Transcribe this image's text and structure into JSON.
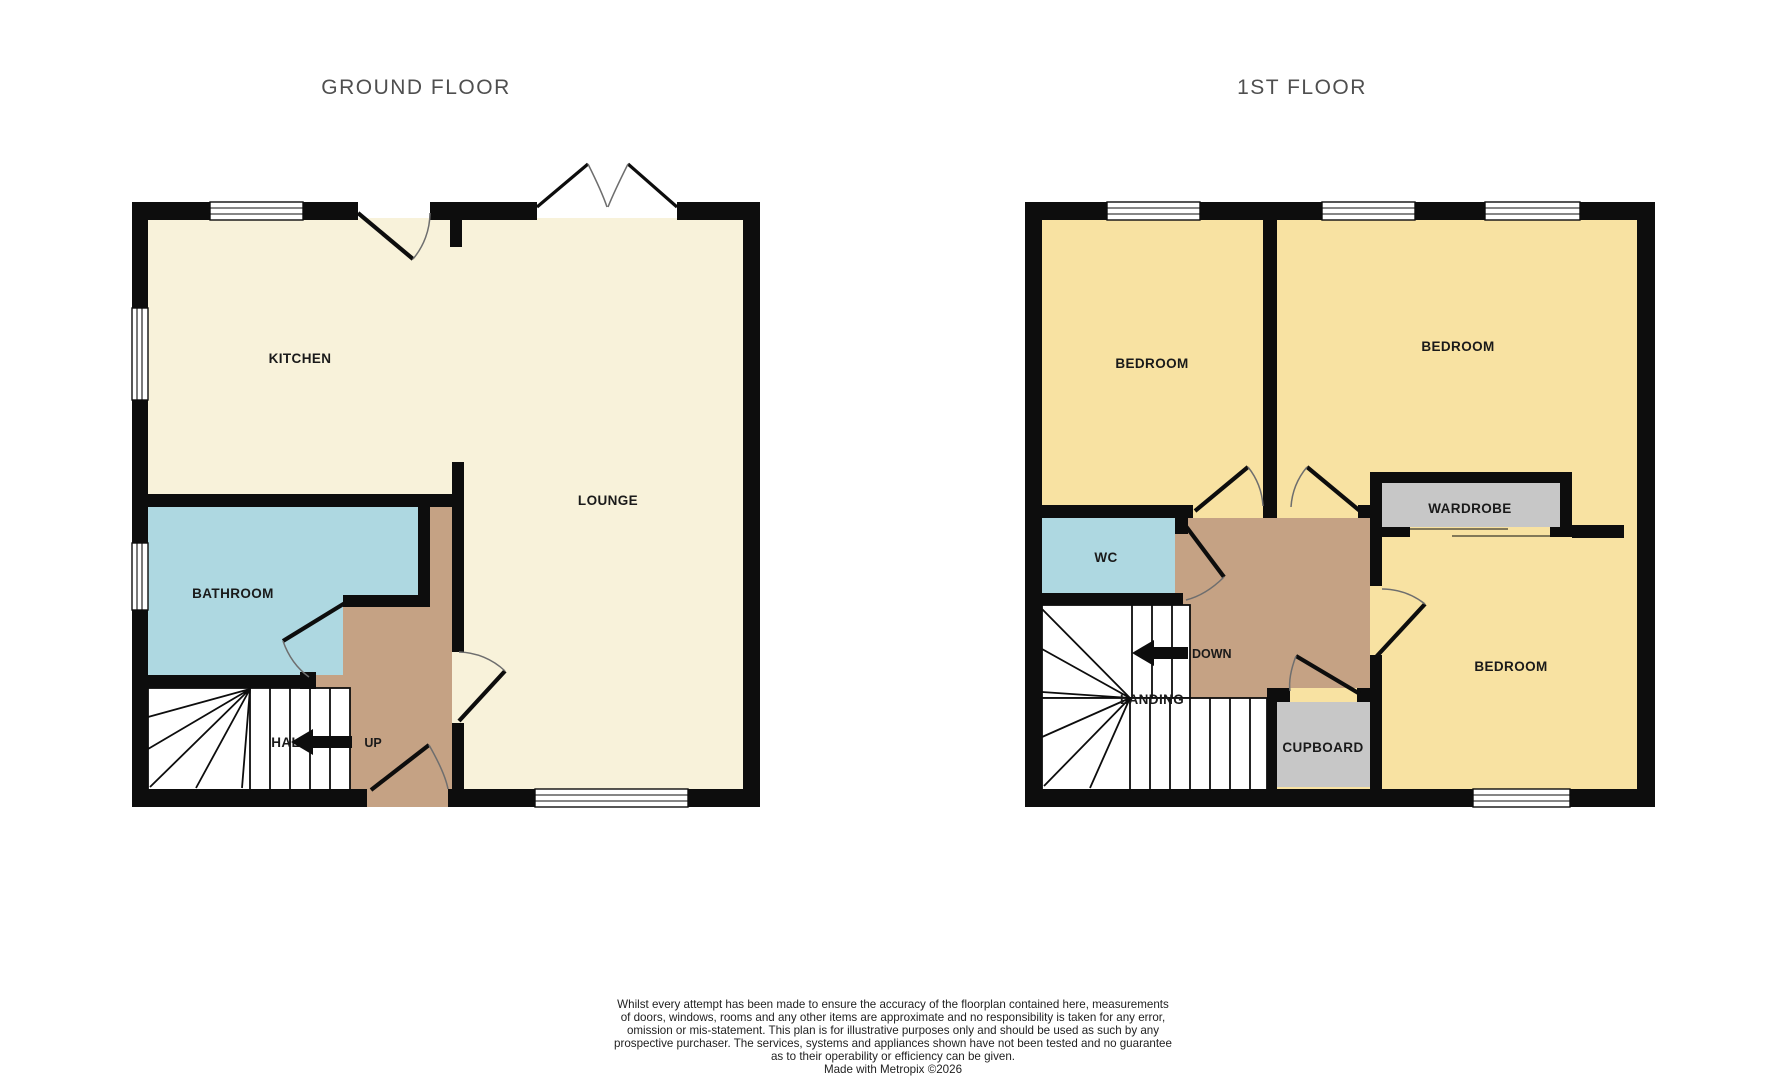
{
  "titles": {
    "ground": "GROUND FLOOR",
    "first": "1ST FLOOR"
  },
  "ground_floor": {
    "rooms": {
      "kitchen": "KITCHEN",
      "lounge": "LOUNGE",
      "bathroom": "BATHROOM",
      "hall": "HALL"
    },
    "stairs_direction": "UP"
  },
  "first_floor": {
    "rooms": {
      "bedroom_left": "BEDROOM",
      "bedroom_right": "BEDROOM",
      "bedroom_bottom": "BEDROOM",
      "wc": "WC",
      "landing": "LANDING",
      "wardrobe": "WARDROBE",
      "cupboard": "CUPBOARD"
    },
    "stairs_direction": "DOWN"
  },
  "disclaimer": {
    "lines": [
      "Whilst every attempt has been made to ensure the accuracy of the floorplan contained here, measurements",
      "of doors, windows, rooms and any other items are approximate and no responsibility is taken for any error,",
      "omission or mis-statement. This plan is for illustrative purposes only and should be used as such by any",
      "prospective purchaser. The services, systems and appliances shown have not been tested and no guarantee",
      "as to their operability or efficiency can be given.",
      "Made with Metropix ©2026"
    ]
  },
  "colors": {
    "wall": "#0d0d0d",
    "cream": "#f8f2da",
    "yellow": "#f8e2a2",
    "blue": "#aed8e1",
    "tan": "#c5a284",
    "gray": "#c7c7c7",
    "arc": "#6e6e6e",
    "title": "#4f4f4f",
    "label": "#1a1a1a",
    "disclaimer": "#1f1f1f"
  }
}
